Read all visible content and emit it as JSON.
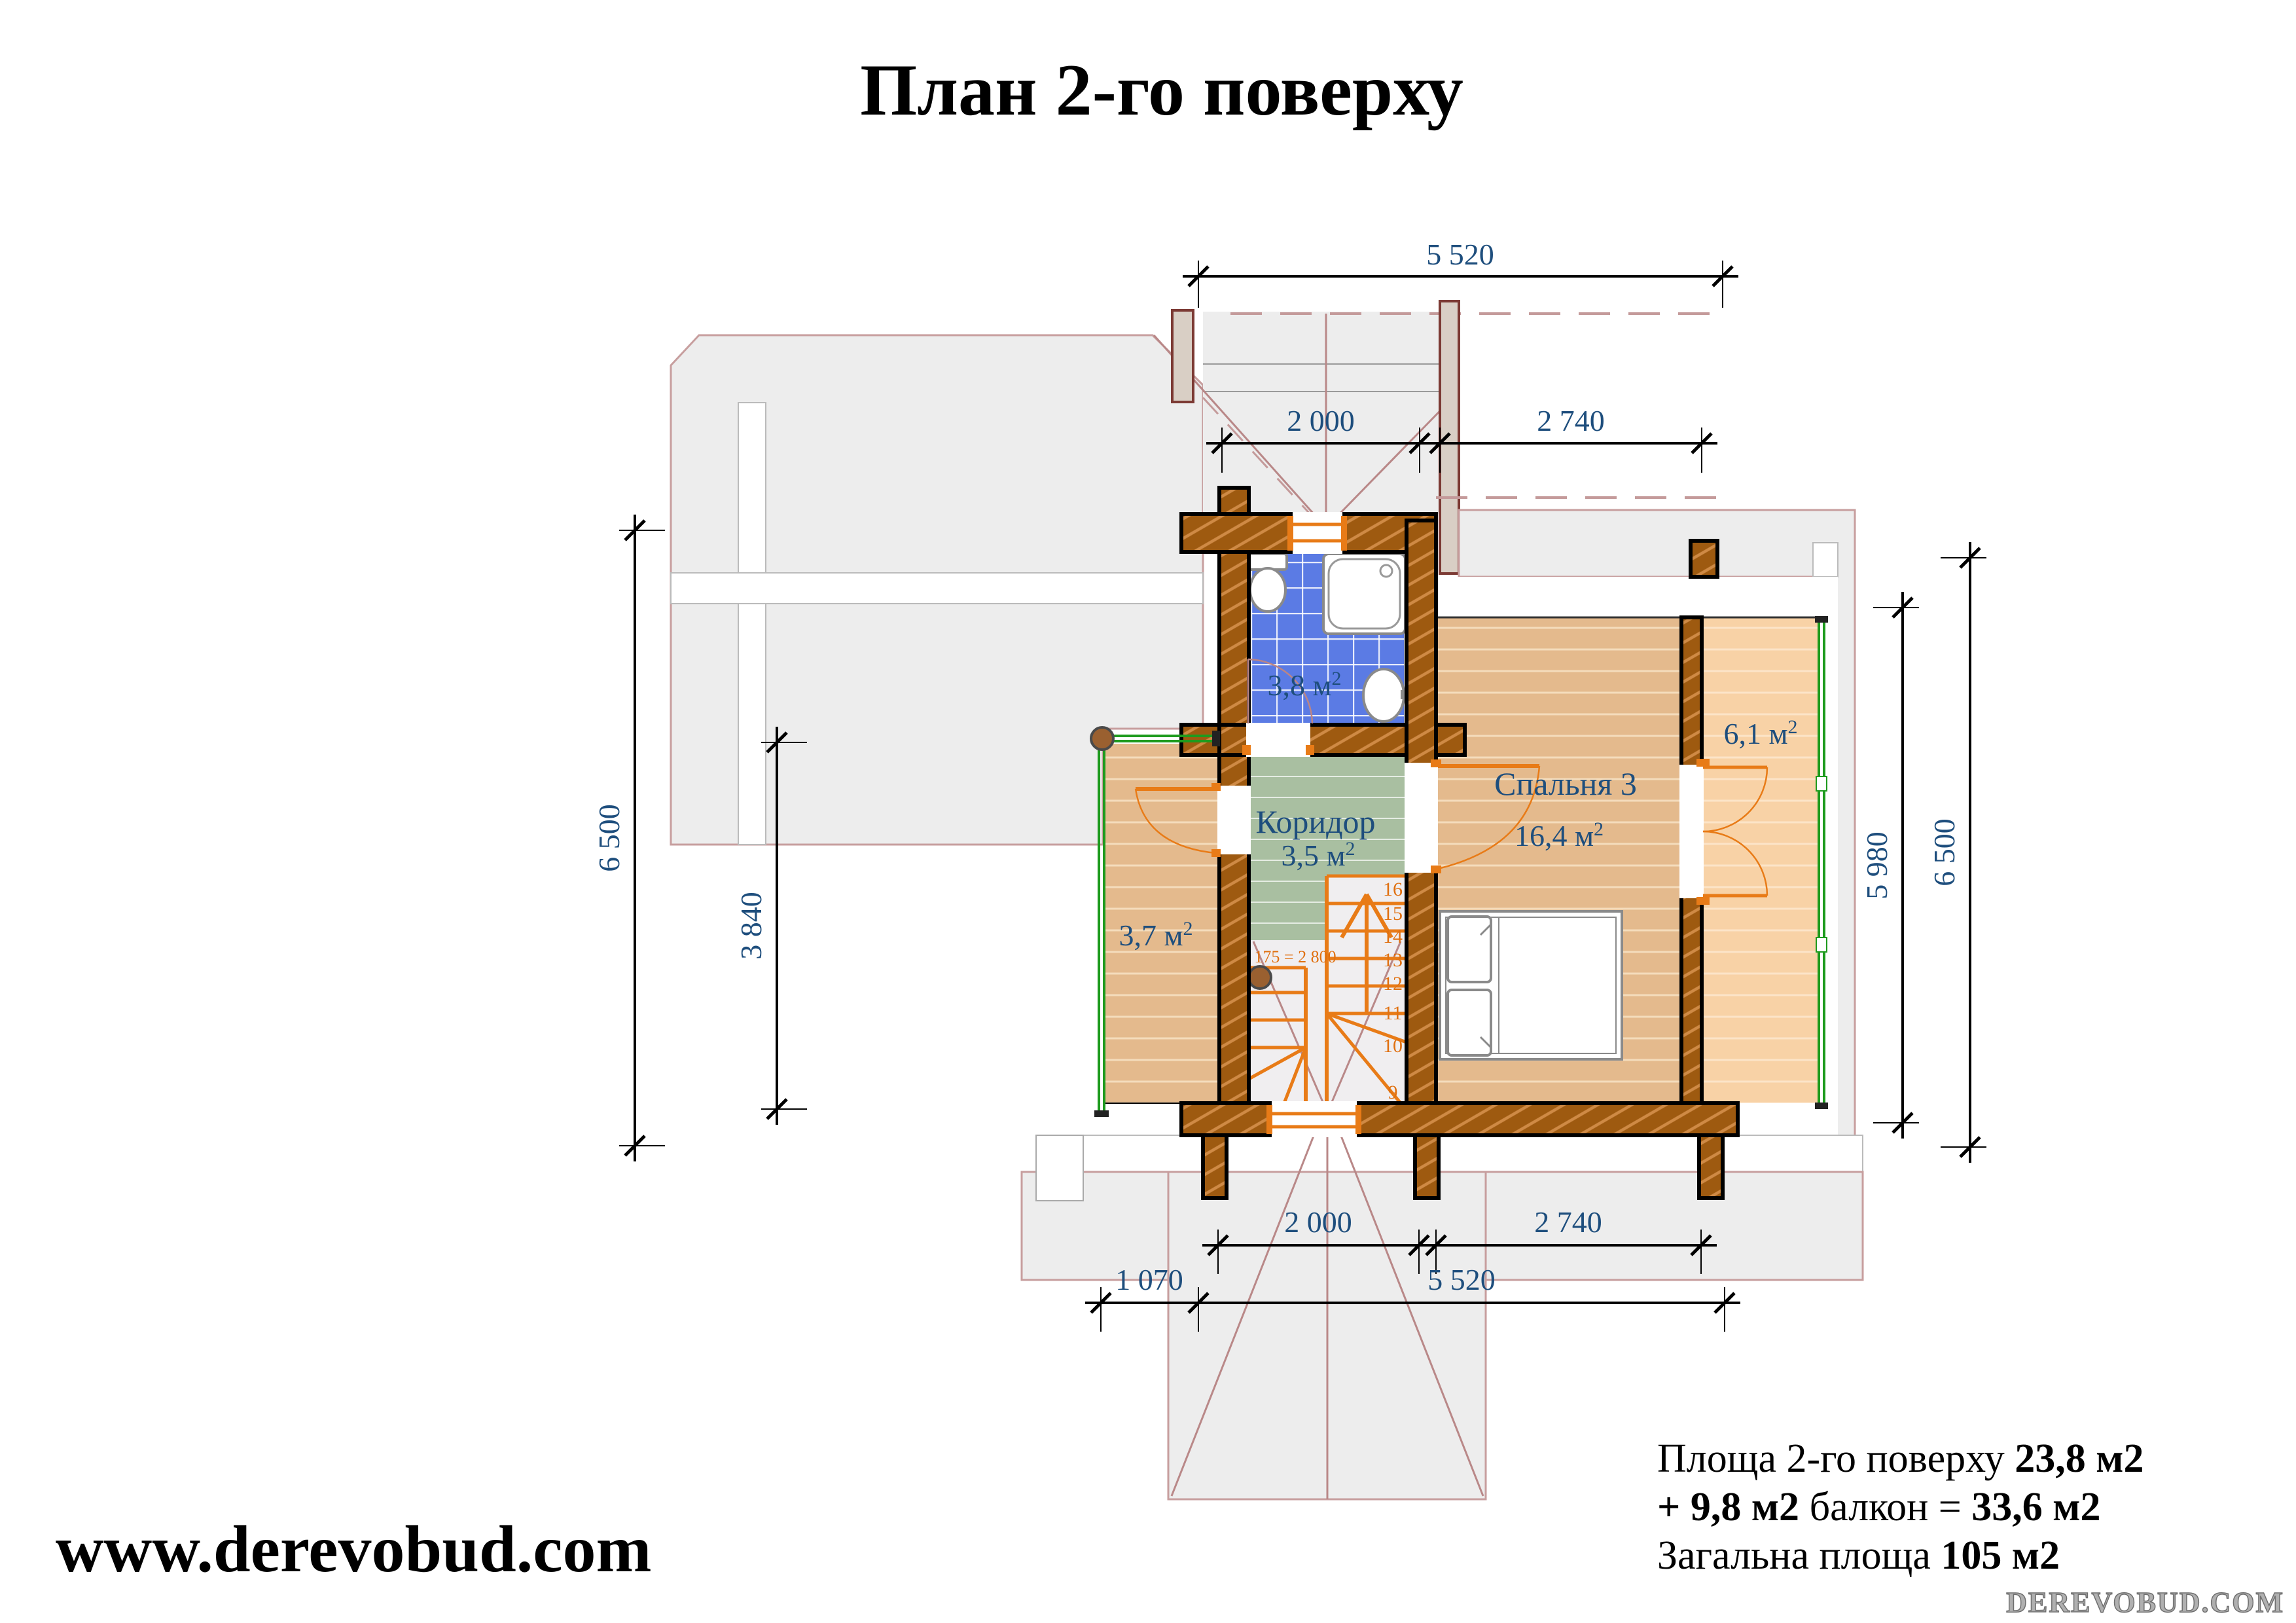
{
  "title": "План 2-го поверху",
  "website": "www.derevobud.com",
  "watermark": "DEREVOBUD.COM",
  "summary": {
    "line1_label": "Площа 2-го поверху ",
    "line1_value": "23,8 м2",
    "line2_bold1": "+ 9,8 м2 ",
    "line2_mid": "балкон = ",
    "line2_bold2": "33,6 м2",
    "line3_label": "Загальна площа ",
    "line3_value": "105 м2"
  },
  "rooms": {
    "bathroom": {
      "area": "3,8 м",
      "sup": "2"
    },
    "corridor": {
      "name": "Коридор",
      "area": "3,5 м",
      "sup": "2"
    },
    "bedroom": {
      "name": "Спальня 3",
      "area": "16,4 м",
      "sup": "2"
    },
    "balcony": {
      "area": "6,1 м",
      "sup": "2"
    },
    "annex": {
      "area": "3,7 м",
      "sup": "2"
    }
  },
  "stairs": {
    "note": "16 х 175 = 2 800",
    "numbers": [
      "1",
      "2",
      "3",
      "4",
      "9",
      "10",
      "11",
      "12",
      "13",
      "14",
      "15",
      "16"
    ]
  },
  "dimensions": {
    "top": {
      "overall": "5 520",
      "left": "2 000",
      "right": "2 740"
    },
    "bottom": {
      "left": "2 000",
      "right": "2 740",
      "offset": "1 070",
      "overall": "5 520"
    },
    "left": {
      "overall": "6 500",
      "annex": "3 840"
    },
    "right": {
      "inner": "5 980",
      "overall": "6 500"
    }
  },
  "colors": {
    "wall": "#9e5a10",
    "bath_tile": "#5b7be4",
    "corridor": "#a9bfa1",
    "bedroom_floor": "#e4ba8d",
    "balcony_floor": "#f8d2a6",
    "accent_orange": "#e87b17",
    "dim_blue": "#1e4e7d",
    "railing_green": "#1e9b1e"
  }
}
